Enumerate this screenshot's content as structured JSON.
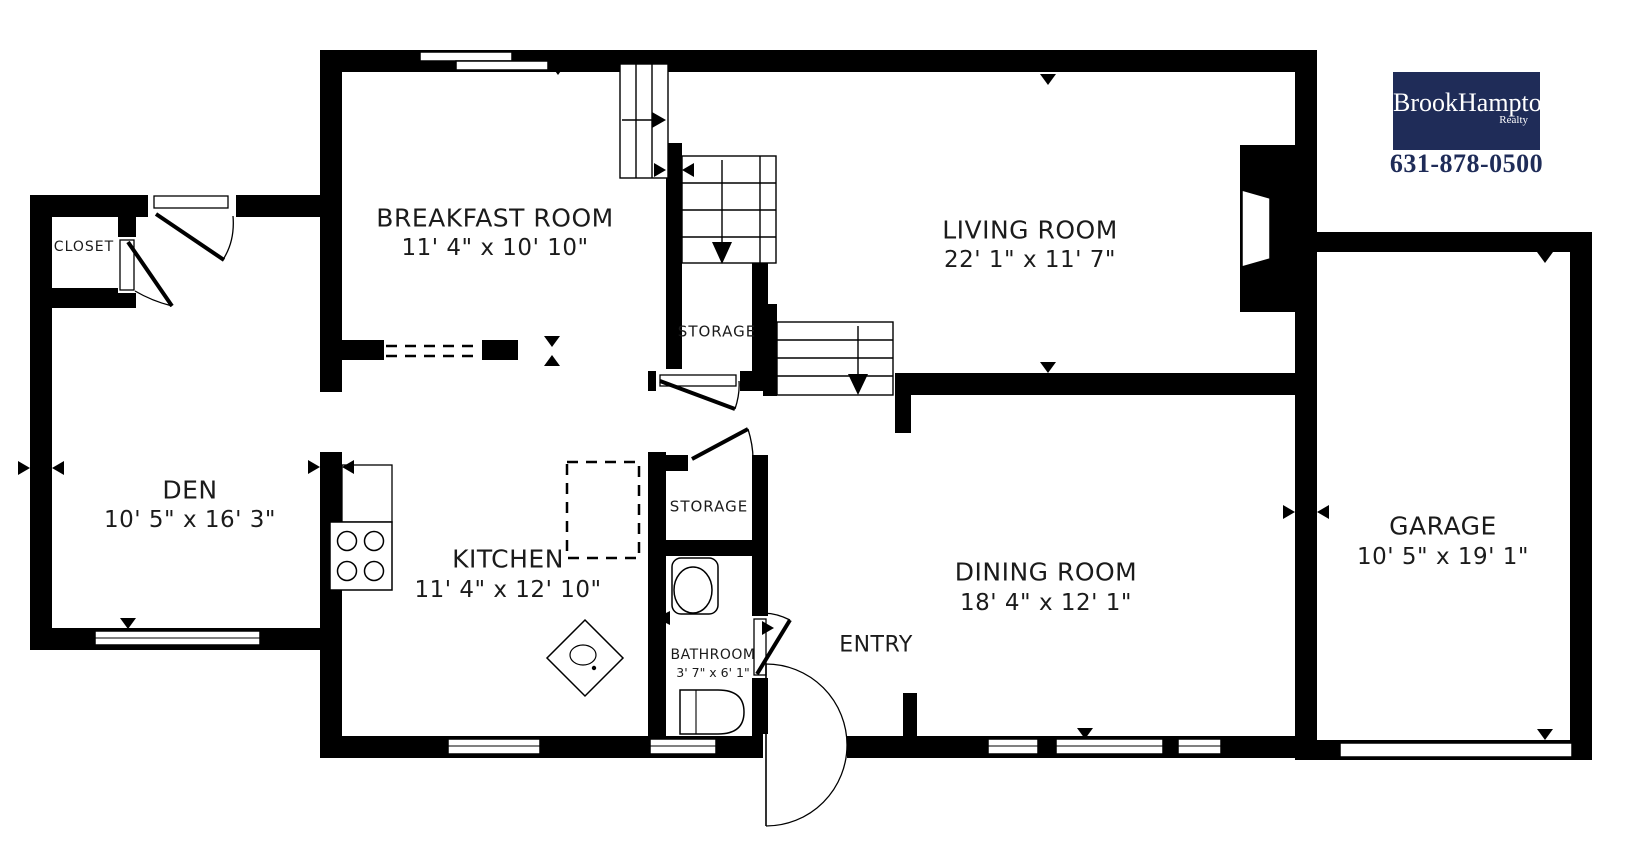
{
  "colors": {
    "wall": "#000000",
    "logo_background": "#1f2c58",
    "phone_text": "#1f2c58",
    "label_text": "#1b1b1b"
  },
  "logo": {
    "brand": "BrookHampton",
    "sub": "Realty",
    "phone": "631-878-0500"
  },
  "rooms": {
    "closet": {
      "name": "CLOSET"
    },
    "breakfast": {
      "name": "BREAKFAST ROOM",
      "dims": "11' 4\" x 10' 10\""
    },
    "living": {
      "name": "LIVING ROOM",
      "dims": "22' 1\" x 11' 7\""
    },
    "den": {
      "name": "DEN",
      "dims": "10' 5\" x 16' 3\""
    },
    "kitchen": {
      "name": "KITCHEN",
      "dims": "11' 4\" x 12' 10\""
    },
    "storage_upper": {
      "name": "STORAGE"
    },
    "storage_lower": {
      "name": "STORAGE"
    },
    "dining": {
      "name": "DINING ROOM",
      "dims": "18' 4\" x 12' 1\""
    },
    "bathroom": {
      "name": "BATHROOM",
      "dims": "3' 7\" x 6' 1\""
    },
    "entry": {
      "name": "ENTRY"
    },
    "garage": {
      "name": "GARAGE",
      "dims": "10' 5\" x 19' 1\""
    }
  }
}
